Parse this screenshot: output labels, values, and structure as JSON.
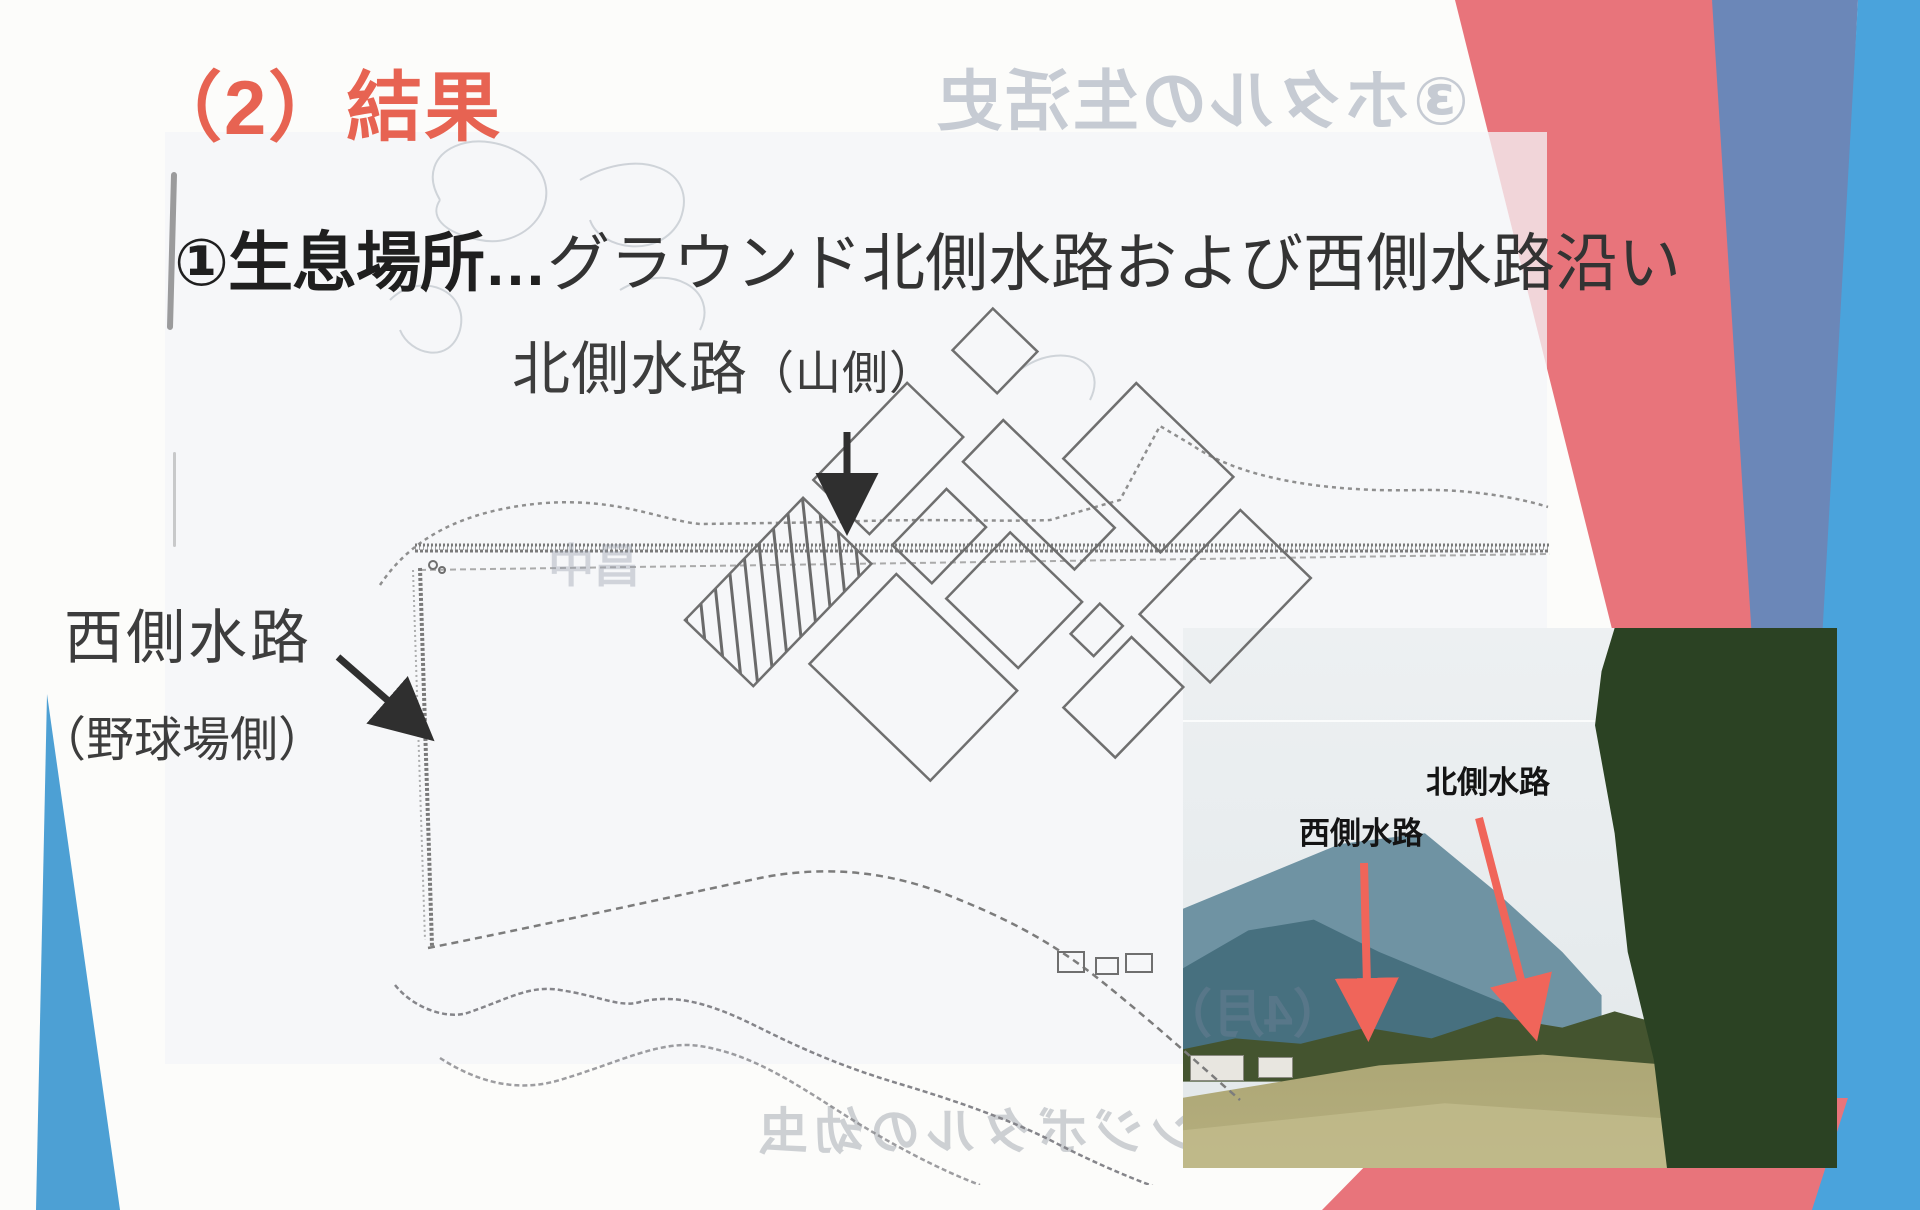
{
  "slide": {
    "title": "（2）結果",
    "heading_bold": "①生息場所",
    "heading_ellipsis": "…",
    "heading_rest": "グラウンド北側水路および西側水路沿い"
  },
  "map_labels": {
    "north_main": "北側水路",
    "north_paren": "（山側）",
    "west_main": "西側水路",
    "west_paren": "（野球場側）"
  },
  "photo_labels": {
    "west": "西側水路",
    "north": "北側水路"
  },
  "bleed_through": {
    "top_right": "③ホタルの生活史",
    "map_center": "昌中",
    "month": "（4月）",
    "bottom": "ゲンジボタルの幼虫"
  },
  "colors": {
    "title_red": "#e76352",
    "band_red": "#e8747b",
    "band_blue_dark": "#6b87b8",
    "band_blue_light": "#4aa3dc",
    "triangle_blue": "#4da0d4",
    "arrow_red": "#f0655a",
    "text_dark": "#2e2e2e"
  }
}
